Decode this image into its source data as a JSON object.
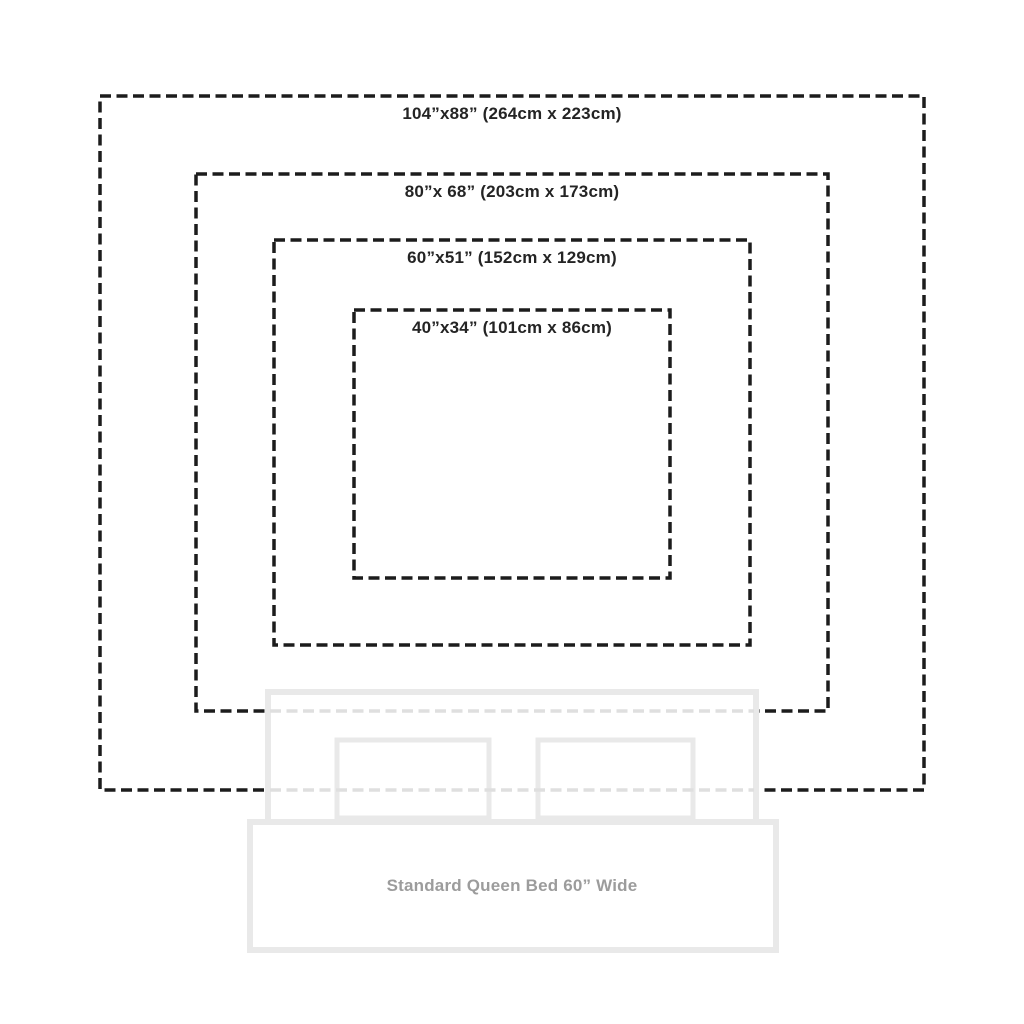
{
  "canvas": {
    "width": 1024,
    "height": 1024,
    "background": "#ffffff"
  },
  "diagram": {
    "type": "nested-size-comparison",
    "dash_color": "#1c1c1c",
    "dash_pattern": "11 5.5",
    "dash_stroke_width": 3.5,
    "label_color": "#242424",
    "faded_dash_color": "#dfdfdf",
    "sizes": [
      {
        "id": "104x88",
        "label": "104”x88” (264cm x 223cm)",
        "inches": [
          104,
          88
        ],
        "cm": [
          264,
          223
        ],
        "box": {
          "x": 100,
          "y": 96,
          "w": 824,
          "h": 694
        }
      },
      {
        "id": "80x68",
        "label": "80”x 68” (203cm x 173cm)",
        "inches": [
          80,
          68
        ],
        "cm": [
          203,
          173
        ],
        "box": {
          "x": 196,
          "y": 174,
          "w": 632,
          "h": 537
        }
      },
      {
        "id": "60x51",
        "label": "60”x51” (152cm x 129cm)",
        "inches": [
          60,
          51
        ],
        "cm": [
          152,
          129
        ],
        "box": {
          "x": 274,
          "y": 240,
          "w": 476,
          "h": 405
        }
      },
      {
        "id": "40x34",
        "label": "40”x34” (101cm x 86cm)",
        "inches": [
          40,
          34
        ],
        "cm": [
          101,
          86
        ],
        "box": {
          "x": 354,
          "y": 310,
          "w": 316,
          "h": 268
        }
      }
    ],
    "bed": {
      "label": "Standard Queen Bed 60” Wide",
      "outline_color": "#e9e9e9",
      "fill_color": "#ffffff",
      "label_color": "#9c9c9c",
      "outline_width": 6,
      "pillow_outline_width": 5,
      "headboard": {
        "x": 268,
        "y": 692,
        "w": 488,
        "h": 133
      },
      "pillows": [
        {
          "x": 337,
          "y": 740,
          "w": 152,
          "h": 78
        },
        {
          "x": 538,
          "y": 740,
          "w": 155,
          "h": 78
        }
      ],
      "body": {
        "x": 250,
        "y": 822,
        "w": 526,
        "h": 128
      }
    }
  }
}
